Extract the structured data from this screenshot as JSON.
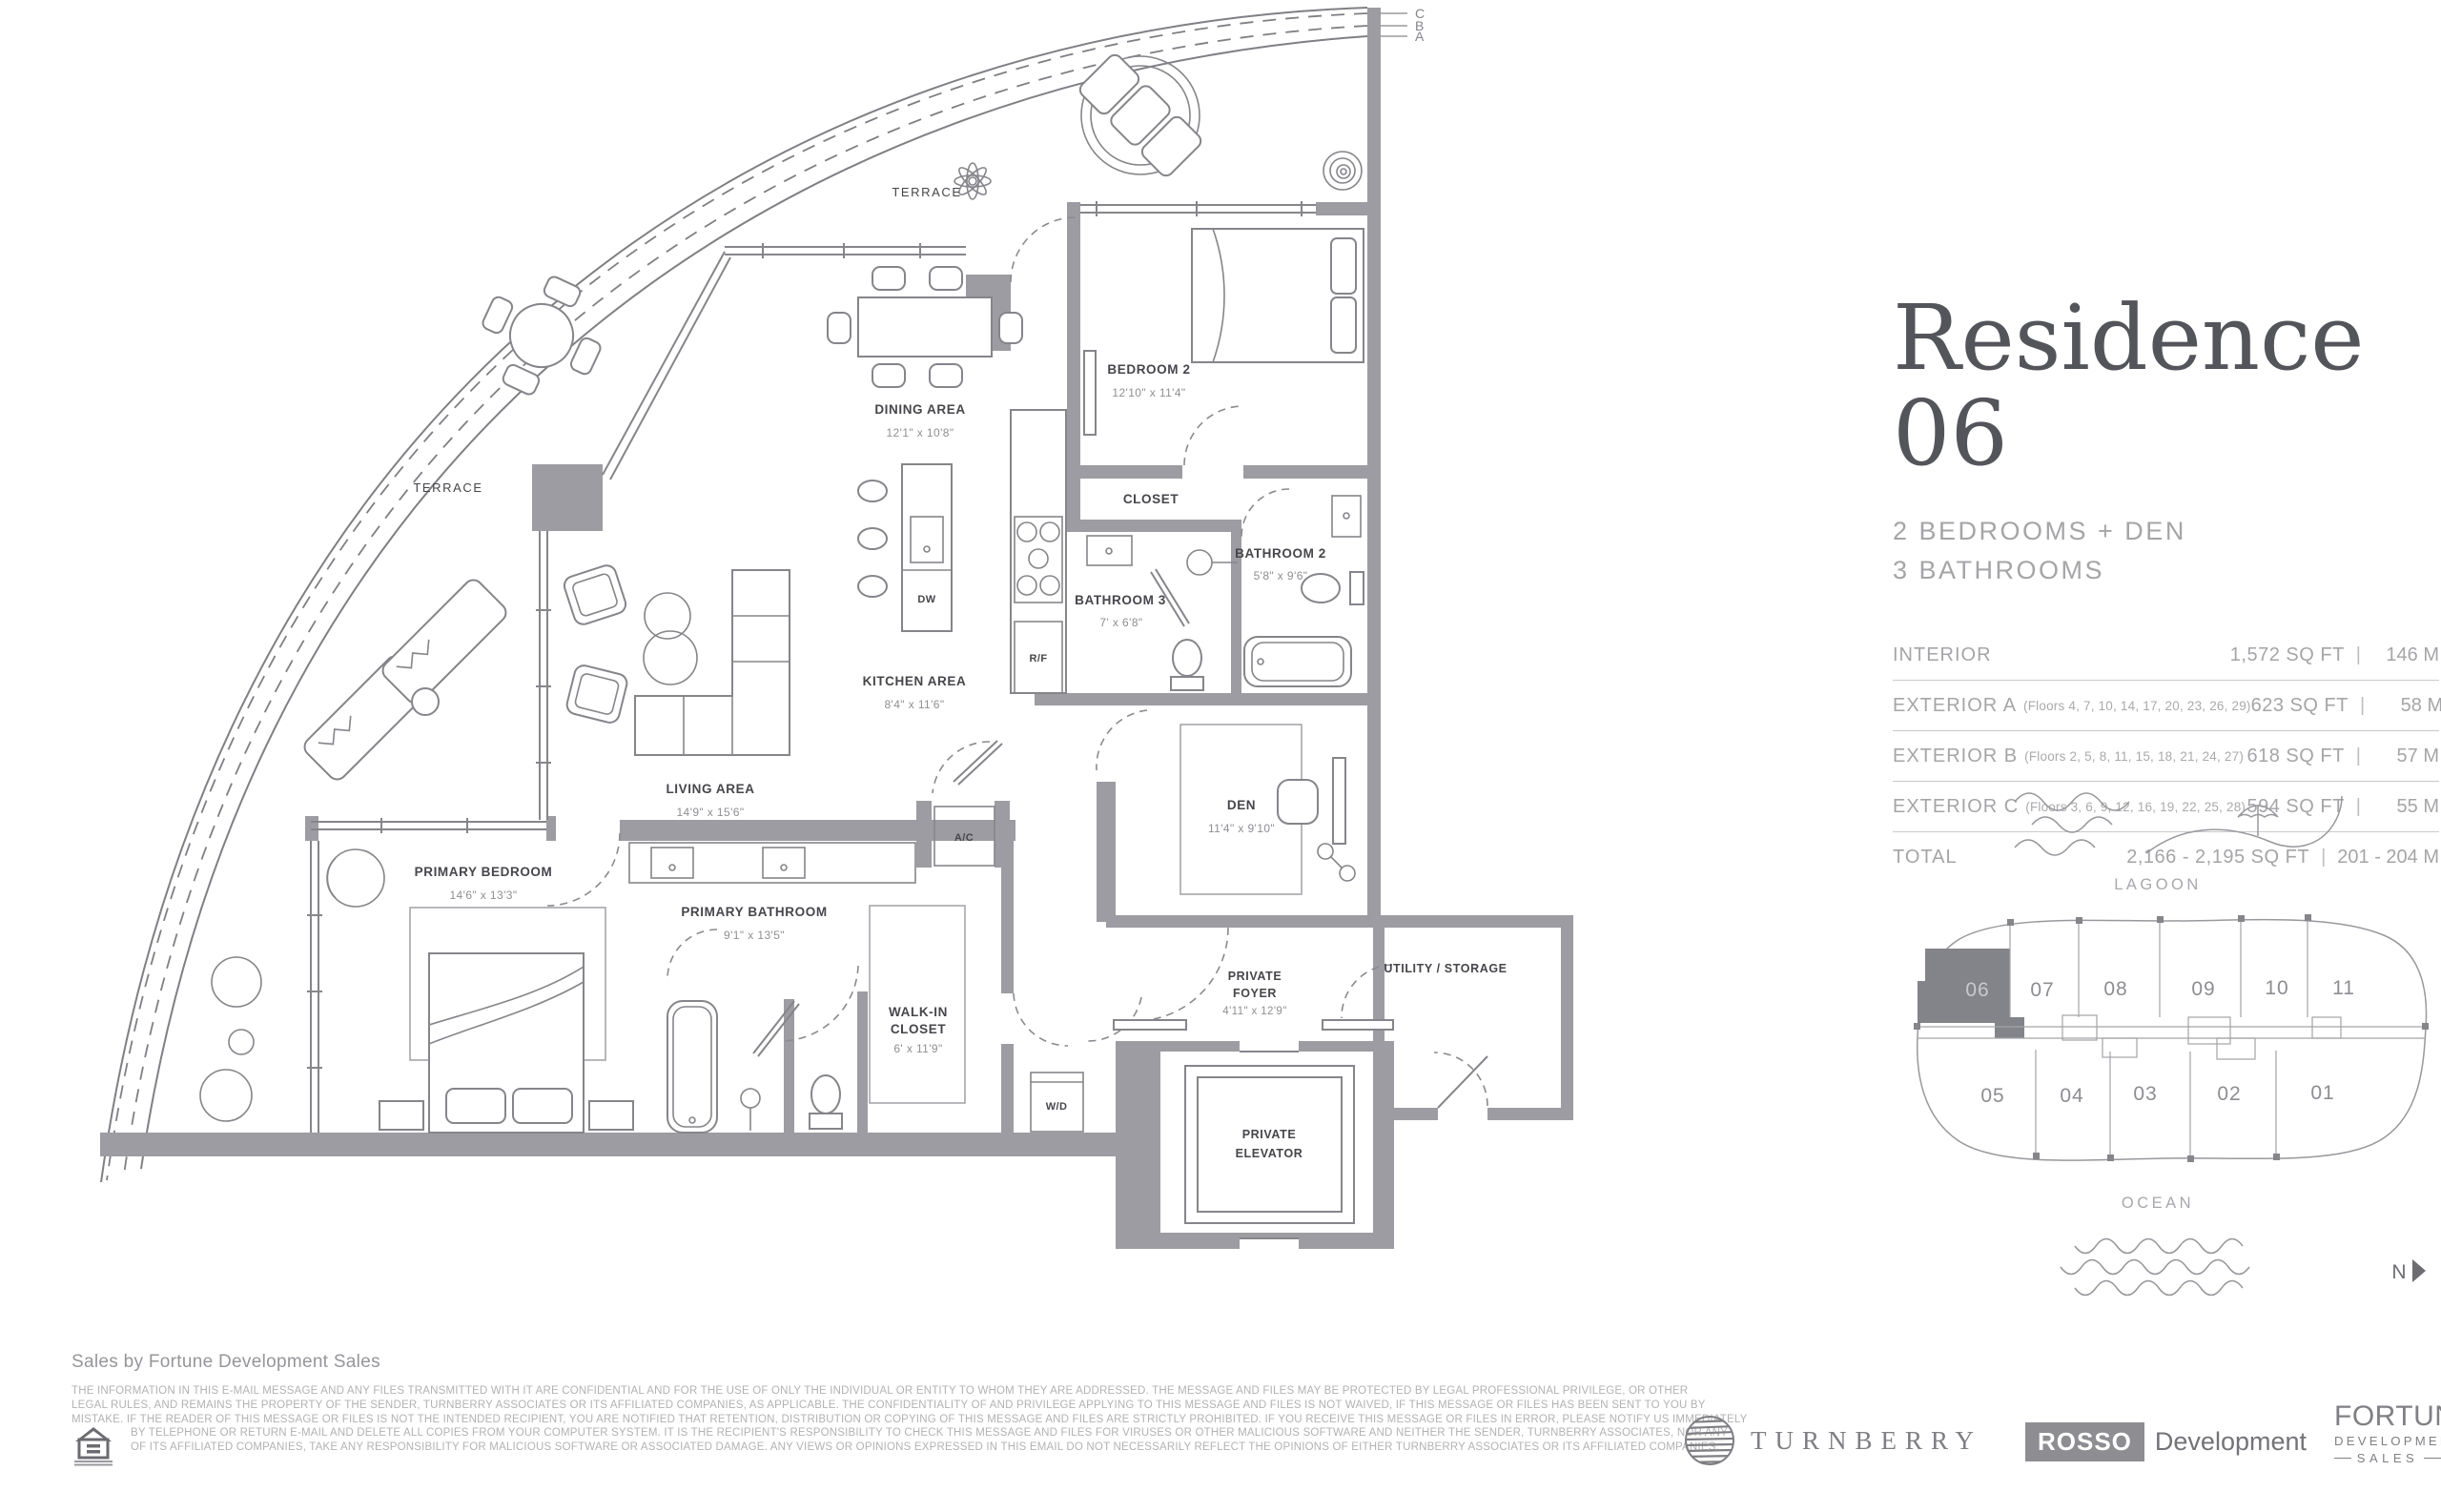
{
  "colors": {
    "wall": "#9c9ca2",
    "line": "#85858a",
    "room_text": "#46464b",
    "muted_text": "#8f8f94",
    "panel_text": "#a5a5a8",
    "title_text": "#54555b",
    "highlight_unit_fill": "#83838a"
  },
  "panel": {
    "title": "Residence 06",
    "subtitle_line1": "2 BEDROOMS + DEN",
    "subtitle_line2": "3 BATHROOMS",
    "specs": [
      {
        "label": "INTERIOR",
        "floors": "",
        "sqft": "1,572 SQ FT",
        "m": "146 M"
      },
      {
        "label": "EXTERIOR A",
        "floors": "(Floors 4, 7, 10, 14, 17, 20, 23, 26, 29)",
        "sqft": "623 SQ FT",
        "m": "58 M"
      },
      {
        "label": "EXTERIOR B",
        "floors": "(Floors 2, 5, 8, 11, 15, 18, 21, 24, 27)",
        "sqft": "618 SQ FT",
        "m": "57 M"
      },
      {
        "label": "EXTERIOR C",
        "floors": "(Floors 3, 6, 9, 12, 16, 19, 22, 25, 28)",
        "sqft": "594 SQ FT",
        "m": "55 M"
      },
      {
        "label": "TOTAL",
        "floors": "",
        "sqft": "2,166 - 2,195 SQ FT",
        "m": "201 - 204 M"
      }
    ]
  },
  "floorplan": {
    "terrace_top": "TERRACE",
    "terrace_left": "TERRACE",
    "section_lines": [
      "C",
      "B",
      "A"
    ],
    "rooms": {
      "dining": {
        "name": "DINING AREA",
        "dims": "12'1\" x 10'8\""
      },
      "bedroom2": {
        "name": "BEDROOM 2",
        "dims": "12'10\" x 11'4\""
      },
      "closet": {
        "name": "CLOSET"
      },
      "bathroom2": {
        "name": "BATHROOM 2",
        "dims": "5'8\" x 9'6\""
      },
      "bathroom3": {
        "name": "BATHROOM 3",
        "dims": "7' x 6'8\""
      },
      "kitchen": {
        "name": "KITCHEN AREA",
        "dims": "8'4\" x 11'6\""
      },
      "living": {
        "name": "LIVING AREA",
        "dims": "14'9\" x 15'6\""
      },
      "primary_bedroom": {
        "name": "PRIMARY BEDROOM",
        "dims": "14'6\" x 13'3\""
      },
      "primary_bathroom": {
        "name": "PRIMARY BATHROOM",
        "dims": "9'1\" x 13'5\""
      },
      "walkin_closet": {
        "line1": "WALK-IN",
        "line2": "CLOSET",
        "dims": "6' x 11'9\""
      },
      "den": {
        "name": "DEN",
        "dims": "11'4\" x 9'10\""
      },
      "private_foyer": {
        "line1": "PRIVATE",
        "line2": "FOYER",
        "dims": "4'11\" x 12'9\""
      },
      "utility": {
        "name": "UTILITY / STORAGE"
      },
      "private_elevator": {
        "line1": "PRIVATE",
        "line2": "ELEVATOR"
      }
    },
    "fixtures": {
      "rf": "R/F",
      "dw": "DW",
      "ac": "A/C",
      "wd": "W/D"
    }
  },
  "keyplan": {
    "lagoon": "LAGOON",
    "ocean": "OCEAN",
    "compass": "N",
    "highlighted_unit": "06",
    "units_top": [
      "06",
      "07",
      "08",
      "09",
      "10",
      "11"
    ],
    "units_bottom": [
      "05",
      "04",
      "03",
      "02",
      "01"
    ]
  },
  "footer": {
    "sales_by": "Sales by Fortune Development Sales",
    "disclaimer_lines": [
      "THE INFORMATION IN THIS E-MAIL MESSAGE AND ANY FILES TRANSMITTED WITH IT ARE CONFIDENTIAL AND FOR THE USE OF ONLY THE INDIVIDUAL OR ENTITY TO WHOM THEY ARE ADDRESSED. THE MESSAGE AND FILES MAY BE PROTECTED BY LEGAL PROFESSIONAL PRIVILEGE, OR OTHER",
      "LEGAL RULES, AND REMAINS THE PROPERTY OF THE SENDER, TURNBERRY ASSOCIATES OR ITS AFFILIATED COMPANIES, AS APPLICABLE. THE CONFIDENTIALITY OF AND PRIVILEGE APPLYING TO THIS MESSAGE AND FILES IS NOT WAIVED, IF THIS MESSAGE OR FILES HAS BEEN SENT TO YOU BY",
      "MISTAKE. IF THE READER OF THIS MESSAGE OR FILES IS NOT THE INTENDED RECIPIENT, YOU ARE NOTIFIED THAT RETENTION, DISTRIBUTION OR COPYING OF THIS MESSAGE AND FILES ARE STRICTLY PROHIBITED. IF YOU RECEIVE THIS MESSAGE OR FILES IN ERROR, PLEASE NOTIFY US IMMEDIATELY",
      "BY TELEPHONE OR RETURN E-MAIL AND DELETE ALL COPIES FROM YOUR COMPUTER SYSTEM. IT IS THE RECIPIENT'S RESPONSIBILITY TO CHECK THIS MESSAGE AND FILES FOR VIRUSES OR OTHER MALICIOUS SOFTWARE AND NEITHER THE SENDER, TURNBERRY ASSOCIATES, NOR ANY",
      "OF ITS AFFILIATED COMPANIES, TAKE ANY RESPONSIBILITY FOR MALICIOUS SOFTWARE OR ASSOCIATED DAMAGE. ANY VIEWS OR OPINIONS EXPRESSED IN THIS EMAIL DO NOT NECESSARILY REFLECT THE OPINIONS OF EITHER TURNBERRY ASSOCIATES OR ITS AFFILIATED COMPANIES."
    ],
    "turnberry": "TURNBERRY",
    "rosso": "ROSSO",
    "rosso_suffix": "Development",
    "fortune_line1": "FORTUNE",
    "fortune_line2": "DEVELOPMENT",
    "fortune_line3": "SALES"
  }
}
